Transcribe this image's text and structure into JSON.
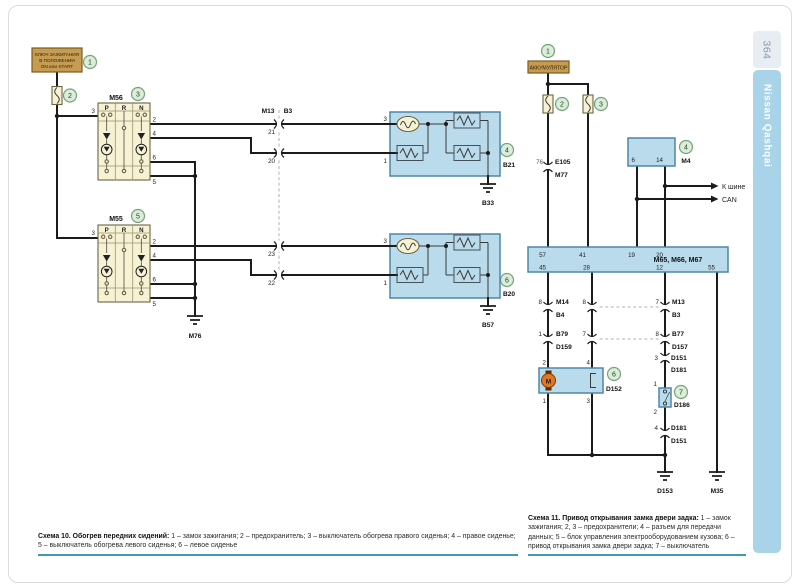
{
  "page": {
    "number": "364",
    "brand": "Nissan Qashqai"
  },
  "colors": {
    "wire": "#1b1b1b",
    "component_blue": "#b9dbec",
    "component_border": "#4e87a8",
    "switch_cream": "#f7f2d4",
    "box_tan": "#c69c53",
    "callout_fill": "#dcecdb",
    "callout_border": "#74a476",
    "sidebar_blue": "#a9d3e8",
    "rule_teal": "#3f9ab8",
    "motor_orange": "#e07820"
  },
  "s10": {
    "ignition": {
      "l1": "КЛЮЧ ЗАЖИГАНИЯ",
      "l2": "В ПОЛОЖЕНИИ",
      "l3": "ON или START"
    },
    "callouts": {
      "c1": "1",
      "c2": "2",
      "c3": "3",
      "c4": "4",
      "c5": "5",
      "c6": "6"
    },
    "m56_label": "M56",
    "m55_label": "M55",
    "cols": {
      "p": "P",
      "r": "R",
      "n": "N"
    },
    "m56_pins": {
      "left": "3",
      "r1": "2",
      "r2": "4",
      "r3": "6",
      "r4": "5"
    },
    "m55_pins": {
      "left": "3",
      "r1": "2",
      "r2": "4",
      "r3": "6",
      "r4": "5"
    },
    "conn": {
      "name1": "M13",
      "name2": "B3",
      "p21": "21",
      "p20": "20",
      "p23": "23",
      "p22": "22"
    },
    "seat_right": {
      "pin3": "3",
      "pin1": "1",
      "code": "B21",
      "ground": "B33"
    },
    "seat_left": {
      "pin3": "3",
      "pin1": "1",
      "code": "B20",
      "ground": "B57"
    },
    "ground_m76": "M76",
    "caption": {
      "title": "Схема 10. Обогрев передних сидений:",
      "text": "1 – замок зажигания; 2 – предохранитель; 3 – выключатель обогрева правого сиденья; 4 – правое сиденье; 5 – выключатель обогрева левого сиденья; 6 – левое сиденье"
    }
  },
  "s11": {
    "battery": "АККУМУЛЯТОР",
    "callouts": {
      "c1": "1",
      "c2": "2",
      "c3": "3",
      "c4": "4",
      "c5": "5",
      "c6": "6",
      "c7": "7"
    },
    "e105": {
      "pin": "76",
      "top": "E105",
      "bottom": "M77"
    },
    "m4": {
      "label": "M4",
      "pin6": "6",
      "pin14": "14"
    },
    "can": {
      "line1": "К шине",
      "line2": "CAN"
    },
    "bcm": {
      "label": "M65, M66, M67",
      "t57": "57",
      "t41": "41",
      "t19": "19",
      "t20": "20",
      "b45": "45",
      "b28": "28",
      "b12": "12",
      "b55": "55"
    },
    "row1": {
      "p8a": "8",
      "m14": "M14",
      "b4": "B4",
      "p8b": "8",
      "p7": "7",
      "m13": "M13",
      "b3": "B3"
    },
    "row2": {
      "p1": "1",
      "b79": "B79",
      "d159": "D159",
      "p7": "7",
      "p8": "8",
      "b77": "B77",
      "d157": "D157"
    },
    "row3": {
      "p3": "3",
      "d151": "D151",
      "d181": "D181"
    },
    "motor": {
      "label": "D152",
      "m": "M",
      "p2": "2",
      "p4": "4",
      "p1": "1",
      "p3": "3"
    },
    "switch": {
      "label": "D186",
      "p1": "1",
      "p2": "2"
    },
    "row4": {
      "p4": "4",
      "d181": "D181",
      "d151": "D151"
    },
    "grounds": {
      "d153": "D153",
      "m35": "M35"
    },
    "caption": {
      "title": "Схема 11. Привод открывания замка двери задка:",
      "text": "1 – замок зажигания; 2, 3 – предохранители; 4 – разъем для передачи данных; 5 – блок управления электрооборудованием кузова; 6 – привод открывания замка двери задка; 7 – выключатель"
    }
  }
}
